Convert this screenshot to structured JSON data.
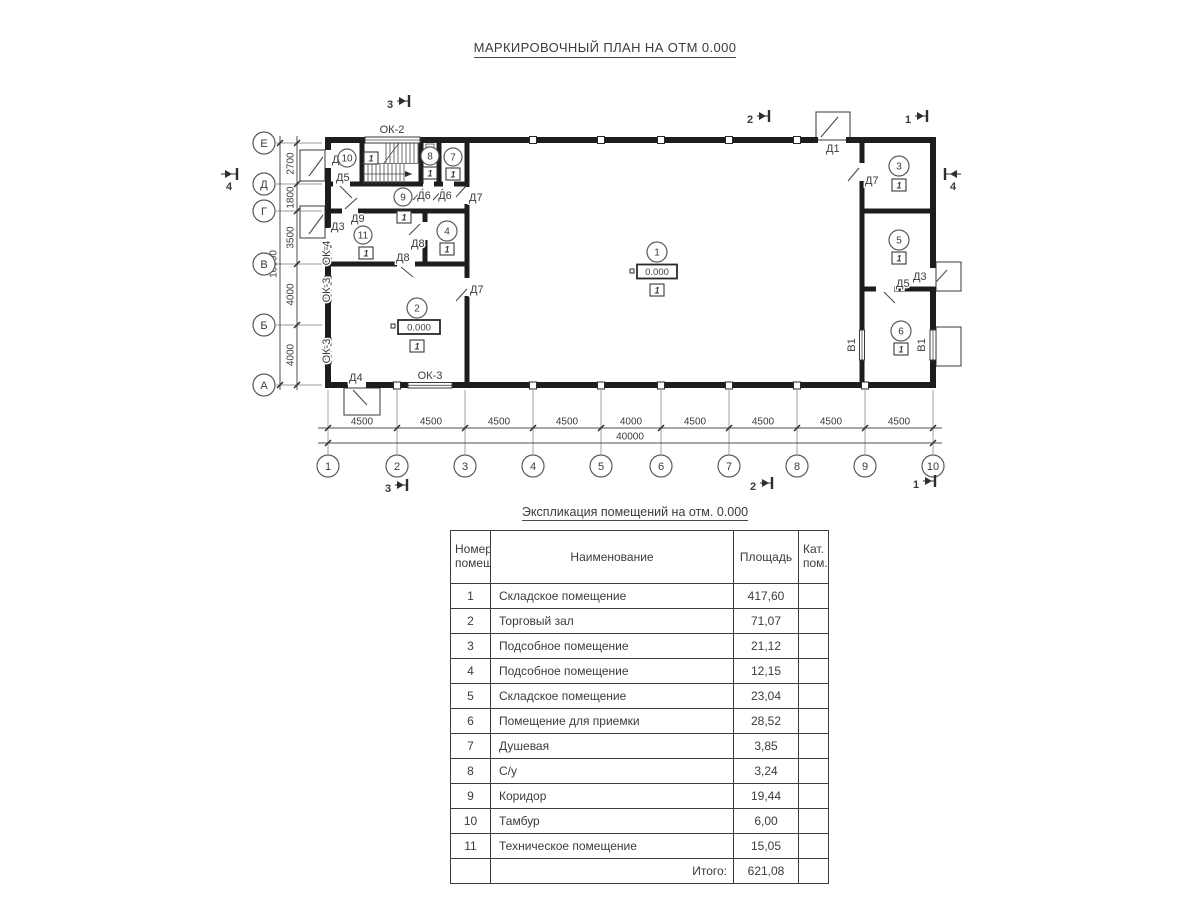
{
  "page": {
    "title_plan": "МАРКИРОВОЧНЫЙ ПЛАН НА ОТМ 0.000"
  },
  "plan": {
    "axes_cols": [
      "1",
      "2",
      "3",
      "4",
      "5",
      "6",
      "7",
      "8",
      "9",
      "10"
    ],
    "axes_rows": [
      "Е",
      "Д",
      "Г",
      "В",
      "Б",
      "А"
    ],
    "dims_bottom": [
      "4500",
      "4500",
      "4500",
      "4500",
      "4000",
      "4500",
      "4500",
      "4500",
      "4500"
    ],
    "dim_bottom_total": "40000",
    "dims_left": [
      "2700",
      "1800",
      "3500",
      "4000",
      "4000"
    ],
    "dim_left_total": "16000",
    "sections": {
      "s1": "1",
      "s2": "2",
      "s3": "3",
      "s4": "4"
    },
    "elevation": "0.000",
    "category_mark": "1",
    "rooms": {
      "r1": "1",
      "r2": "2",
      "r3": "3",
      "r4": "4",
      "r5": "5",
      "r6": "6",
      "r7": "7",
      "r8": "8",
      "r9": "9",
      "r10": "10",
      "r11": "11"
    },
    "doors": {
      "d1": "Д1",
      "d2": "Д2",
      "d3": "Д3",
      "d4": "Д4",
      "d5": "Д5",
      "d6": "Д6",
      "d7": "Д7",
      "d8": "Д8",
      "d9": "Д9"
    },
    "windows": {
      "ok2": "ОК-2",
      "ok3": "ОК-3",
      "ok4": "ОК-4"
    },
    "gate_label": "В1"
  },
  "table": {
    "title": "Экспликация помещений на отм. 0.000",
    "headers": {
      "num": "Номер помещ.",
      "name": "Наименование",
      "area": "Площадь",
      "cat": "Кат. пом."
    },
    "rows": [
      {
        "num": "1",
        "name": "Складское помещение",
        "area": "417,60",
        "cat": ""
      },
      {
        "num": "2",
        "name": "Торговый зал",
        "area": "71,07",
        "cat": ""
      },
      {
        "num": "3",
        "name": "Подсобное помещение",
        "area": "21,12",
        "cat": ""
      },
      {
        "num": "4",
        "name": "Подсобное помещение",
        "area": "12,15",
        "cat": ""
      },
      {
        "num": "5",
        "name": "Складское помещение",
        "area": "23,04",
        "cat": ""
      },
      {
        "num": "6",
        "name": "Помещение для приемки",
        "area": "28,52",
        "cat": ""
      },
      {
        "num": "7",
        "name": "Душевая",
        "area": "3,85",
        "cat": ""
      },
      {
        "num": "8",
        "name": "С/у",
        "area": "3,24",
        "cat": ""
      },
      {
        "num": "9",
        "name": "Коридор",
        "area": "19,44",
        "cat": ""
      },
      {
        "num": "10",
        "name": "Тамбур",
        "area": "6,00",
        "cat": ""
      },
      {
        "num": "11",
        "name": "Техническое помещение",
        "area": "15,05",
        "cat": ""
      }
    ],
    "total_label": "Итого:",
    "total_value": "621,08"
  }
}
